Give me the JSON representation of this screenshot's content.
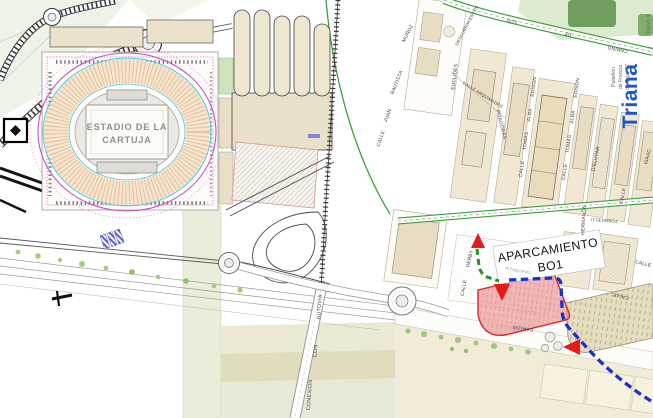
{
  "map_title": "Plano acceso Estadio de la Cartuja - Aparcamiento BO1",
  "colors": {
    "parking_fill": "#e88b8b",
    "parking_border": "#d42a2a",
    "route_blue": "#1733cf",
    "route_green": "#2e8e2e",
    "arrow_red": "#e31b1b",
    "triana_blue": "#1d55c9",
    "green_road": "#3aa23a",
    "stadium_magenta": "#c94fc9",
    "stadium_cyan": "#49c8d9",
    "block_beige": "#f1e8d4",
    "khaki_band": "#ebe8d3"
  },
  "stadium": {
    "line1": "ESTADIO DE LA",
    "line2": "CARTUJA"
  },
  "banner": {
    "line1": "APARCAMIENTO",
    "line2": "BO1"
  },
  "district_label": "Triana",
  "pavilion_expo": {
    "line1": "Pabellón",
    "line2": "de Francia",
    "line3": "de Expo 92",
    "corner": "Pabel. d"
  },
  "streets": [
    {
      "label": "DESCUBRIMIENTOS"
    },
    {
      "label": "LOS"
    },
    {
      "label": "DE"
    },
    {
      "label": "CAMINO"
    },
    {
      "label": "EUCLIDES"
    },
    {
      "label": "CALLE ARQUIMEDES"
    },
    {
      "label": "PITAGORAS"
    },
    {
      "label": "CALLE"
    },
    {
      "label": "TOMAS"
    },
    {
      "label": "ALBA"
    },
    {
      "label": "EDISON"
    },
    {
      "label": "CALLE"
    },
    {
      "label": "TOMAS"
    },
    {
      "label": "ALBA"
    },
    {
      "label": "EDISON"
    },
    {
      "label": "D'ELUYAR"
    },
    {
      "label": "HERMANOS"
    },
    {
      "label": "CALLE"
    },
    {
      "label": "ISAAC"
    },
    {
      "label": "TORRICELLI"
    },
    {
      "label": "CALLE"
    },
    {
      "label": "CALLE"
    },
    {
      "label": "CALLE"
    },
    {
      "label": "JUAN"
    },
    {
      "label": "BAUTISTA"
    },
    {
      "label": "MUÑOZ"
    },
    {
      "label": "AUTOVIA"
    },
    {
      "label": "CON"
    },
    {
      "label": "CONEXION"
    },
    {
      "label": "CALLE"
    },
    {
      "label": "DERBY"
    },
    {
      "label": "CARLOS"
    },
    {
      "label": "PITAGORAS"
    }
  ]
}
